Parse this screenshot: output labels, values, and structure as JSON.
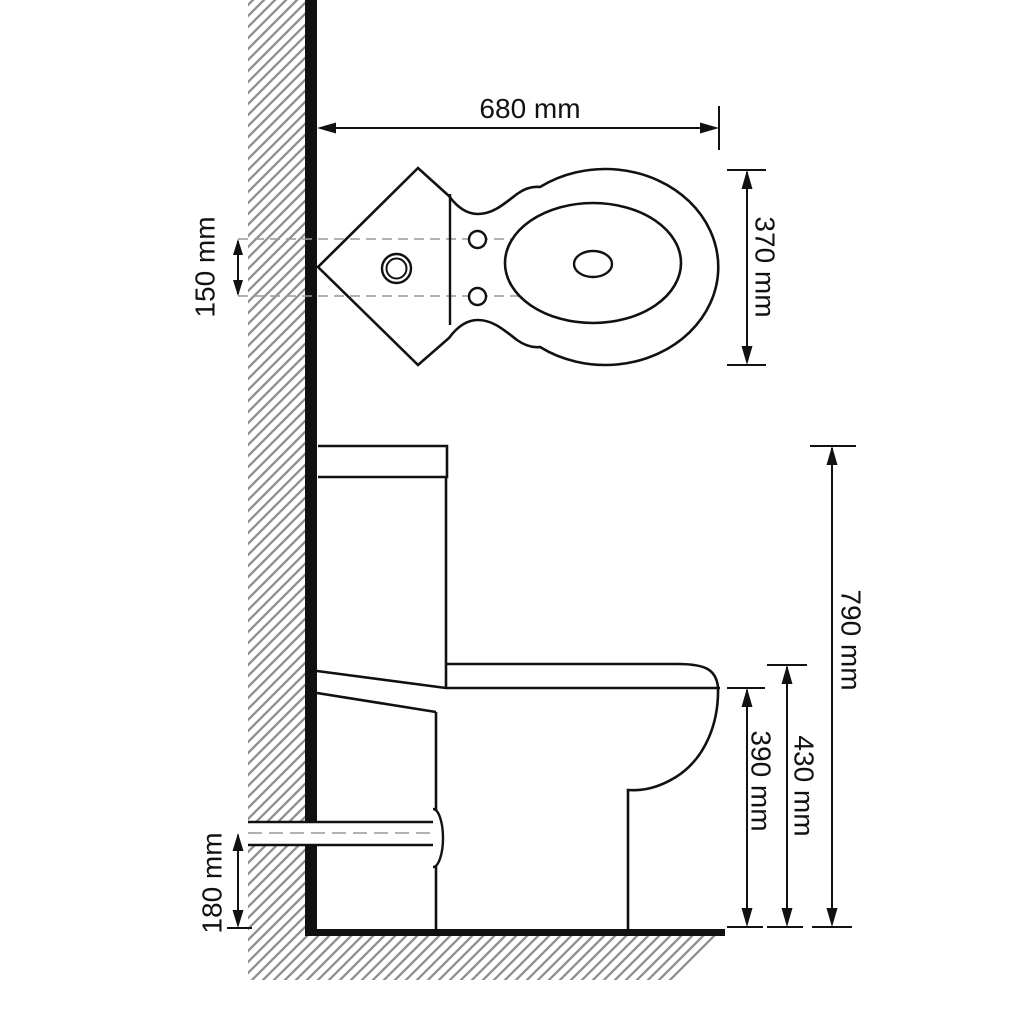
{
  "drawing": {
    "type": "toilet-technical-dimension-drawing",
    "views": {
      "top_view": "corner toilet plan view",
      "side_view": "toilet side elevation"
    },
    "colors": {
      "line": "#111111",
      "hatch": "#8f8f8f",
      "background": "#ffffff",
      "centerline": "#999999"
    },
    "unit": "mm"
  },
  "dimensions": {
    "top_width": {
      "value": 680,
      "unit": "mm",
      "label": "680 mm"
    },
    "bowl_depth": {
      "value": 370,
      "unit": "mm",
      "label": "370 mm"
    },
    "inlet_offset": {
      "value": 150,
      "unit": "mm",
      "label": "150 mm"
    },
    "total_height": {
      "value": 790,
      "unit": "mm",
      "label": "790 mm"
    },
    "seat_height": {
      "value": 430,
      "unit": "mm",
      "label": "430 mm"
    },
    "bowl_height": {
      "value": 390,
      "unit": "mm",
      "label": "390 mm"
    },
    "outlet_height": {
      "value": 180,
      "unit": "mm",
      "label": "180 mm"
    }
  }
}
